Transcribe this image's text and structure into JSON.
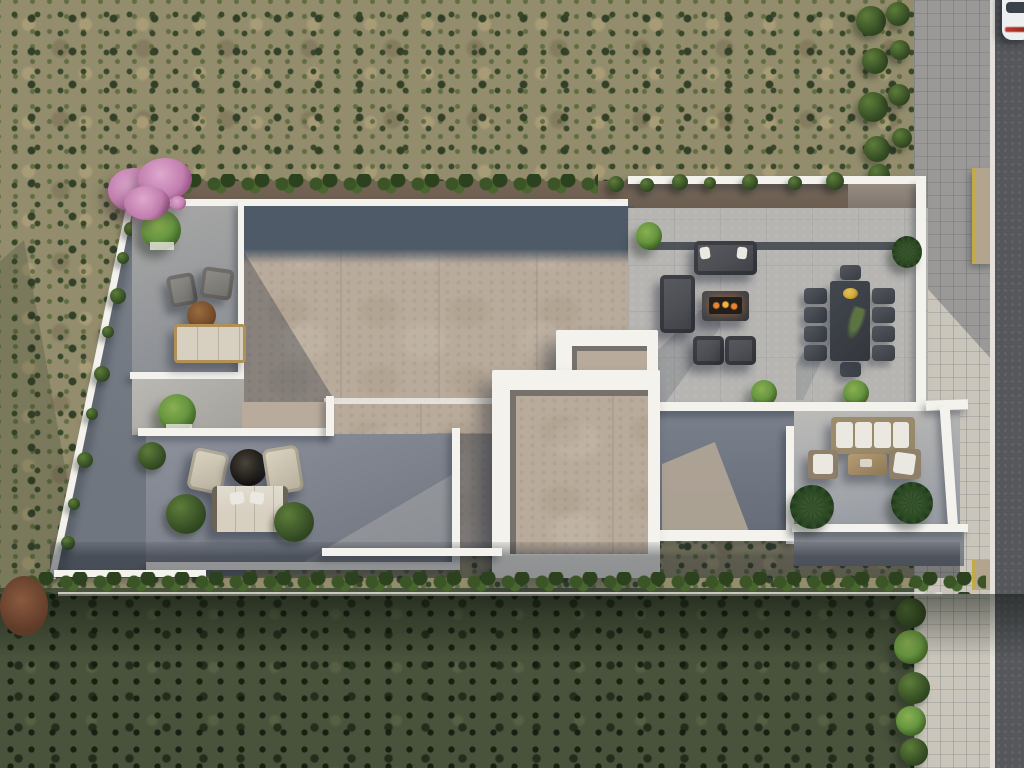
{
  "scene": {
    "type": "aerial-architectural-render",
    "description": "Top-down aerial 3D rendering of a modern flat-roof villa with white parapet walls, beige roof decks and gray rooftop terraces furnished with outdoor lounges, set in olive scrubland with a road, sidewalk and parked white car along the right edge",
    "lighting": "daylight, sun from upper right, shadows cast to lower left",
    "vegetation": [
      "scrubland",
      "pink-blossom-tree",
      "top-hedge-row",
      "bottom-hedge-row",
      "roadside-bushes",
      "boundary-wall-shrubs",
      "terrace-trees",
      "palm-planters",
      "rust-colored-bush"
    ],
    "structures": [
      "villa-roof-deck",
      "skylight-volume",
      "white-boundary-walls",
      "side-yard",
      "sunken-patio",
      "road",
      "sidewalk",
      "driveway-ramp"
    ],
    "furniture": {
      "upper_left_terrace": [
        "gray-armchair",
        "gray-armchair",
        "round-wood-table",
        "beige-outdoor-sofa",
        "potted-tree"
      ],
      "fire_lounge": [
        "three-seat-sofa",
        "two-seat-sofa",
        "fire-pit-table-with-flames",
        "armchair",
        "armchair"
      ],
      "dining_set": {
        "table": 1,
        "chairs": 10,
        "centerpiece": "gold-bowl-with-plant"
      },
      "lower_left_terrace": [
        "lounge-chair",
        "lounge-chair",
        "round-fire-bowl",
        "beige-outdoor-sofa",
        "shrub-planters"
      ],
      "lower_right_terrace": [
        "large-cushion-sofa",
        "armchair",
        "armchair",
        "wood-coffee-table",
        "palm-planters"
      ]
    },
    "vehicles": [
      {
        "name": "white-car",
        "location": "parked on road, top right corner"
      }
    ]
  },
  "palette": {
    "wall-white": "#f3f2ed",
    "roof-beige": "#b9ab9b",
    "roof-slate": "#4e5a68",
    "terrace-gray": "#b6b5b2",
    "terrace-shadow": "#767d89",
    "yard-gray": "#898e97",
    "dirt-brown": "#6f6152",
    "hedge-green": "#2f4520",
    "tree-green": "#679540",
    "palm-green": "#2c4a24",
    "blossom-pink": "#c27fb0",
    "scrub-base": "#938d6d",
    "scrub-dark": "#49523b",
    "road-asphalt": "#55575b",
    "sidewalk-tan": "#c9c5bb",
    "line-white": "#e3e1da",
    "car-white": "#edeff1",
    "taillight-red": "#c23b2e",
    "sofa-charcoal": "#4d4f55",
    "cushion-cream": "#eae8e1",
    "sofa-beige": "#d7d0c1",
    "wood-brown": "#8a6a45",
    "table-charcoal": "#3b3f46",
    "gold": "#cfa733",
    "fire-orange": "#e8832f",
    "ramp-tan": "#b3a48e",
    "ramp-yellow": "#c2a94b"
  }
}
